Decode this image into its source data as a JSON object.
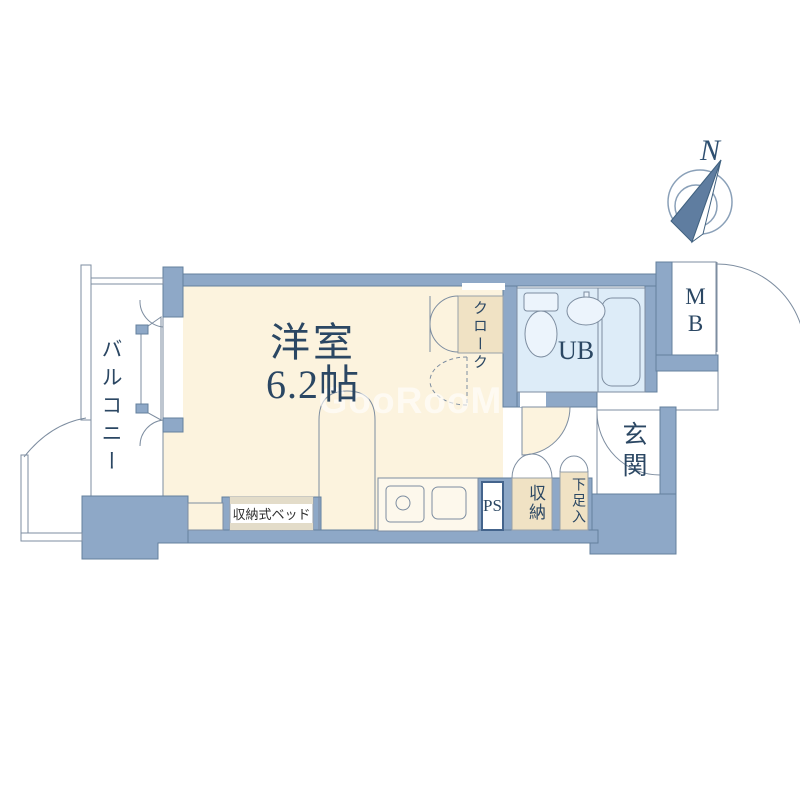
{
  "colors": {
    "wall": "#8ea8c7",
    "wall_stroke": "#64809e",
    "floor": "#fcf3de",
    "tan": "#f0e2c4",
    "bath": "#ddecf8",
    "line": "#7d8da0",
    "text": "#2b4763"
  },
  "compass": {
    "north_label": "N"
  },
  "watermark": {
    "text": "GooRooM"
  },
  "labels": {
    "main_room_name": "洋室",
    "main_room_size": "6.2帖",
    "balcony": "バルコニー",
    "cloak": "クローク",
    "unit_bath": "UB",
    "meter_box": "MB",
    "entrance": "玄関",
    "pipe_space": "PS",
    "storage": "収納",
    "shoe_cabinet": "下足入",
    "folding_bed": "収納式ベッド"
  }
}
